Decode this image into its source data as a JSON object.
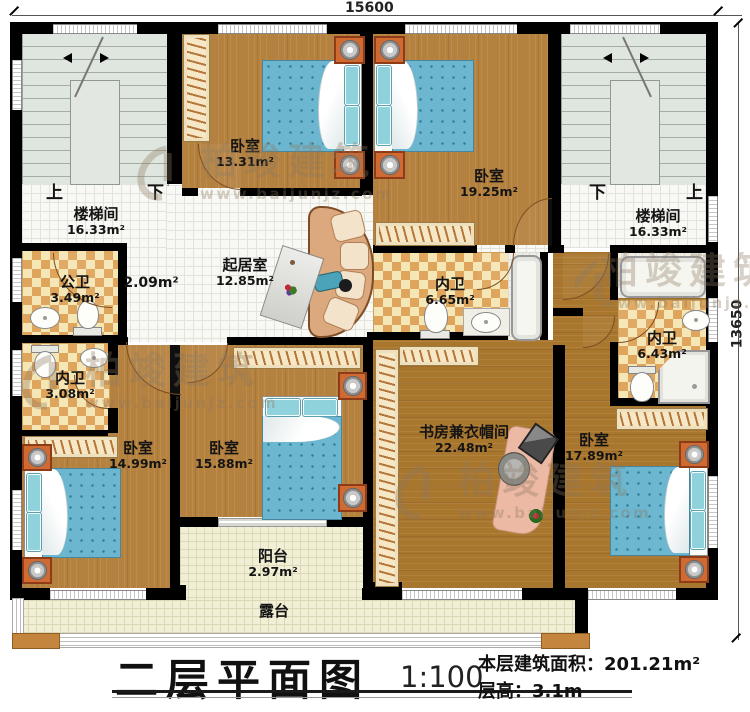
{
  "dimensions": {
    "top": "15600",
    "right": "13650"
  },
  "stairs": {
    "up": "上",
    "down": "下"
  },
  "rooms": {
    "stair_left": {
      "name": "楼梯间",
      "area": "16.33m²"
    },
    "stair_right": {
      "name": "楼梯间",
      "area": "16.33m²"
    },
    "bedroom_nw": {
      "name": "卧室",
      "area": "13.31m²"
    },
    "bedroom_ne": {
      "name": "卧室",
      "area": "19.25m²"
    },
    "public_bath": {
      "name": "公卫",
      "area": "3.49m²"
    },
    "living": {
      "name": "起居室",
      "area": "12.85m²"
    },
    "hall": {
      "area": "2.09m²"
    },
    "bath_center": {
      "name": "内卫",
      "area": "6.65m²"
    },
    "bath_right": {
      "name": "内卫",
      "area": "6.43m²"
    },
    "bath_left": {
      "name": "内卫",
      "area": "3.08m²"
    },
    "bedroom_sw": {
      "name": "卧室",
      "area": "14.99m²"
    },
    "bedroom_sm": {
      "name": "卧室",
      "area": "15.88m²"
    },
    "study": {
      "name": "书房兼衣帽间",
      "area": "22.48m²"
    },
    "bedroom_se": {
      "name": "卧室",
      "area": "17.89m²"
    },
    "balcony": {
      "name": "阳台",
      "area": "2.97m²"
    },
    "terrace": {
      "name": "露台"
    }
  },
  "title_block": {
    "title": "二层平面图",
    "scale": "1:100",
    "area_line": "本层建筑面积：201.21m²",
    "height_line": "层高：3.1m"
  },
  "watermark": {
    "brand": "柏竣建筑",
    "url": "www.baijunjz.com"
  }
}
